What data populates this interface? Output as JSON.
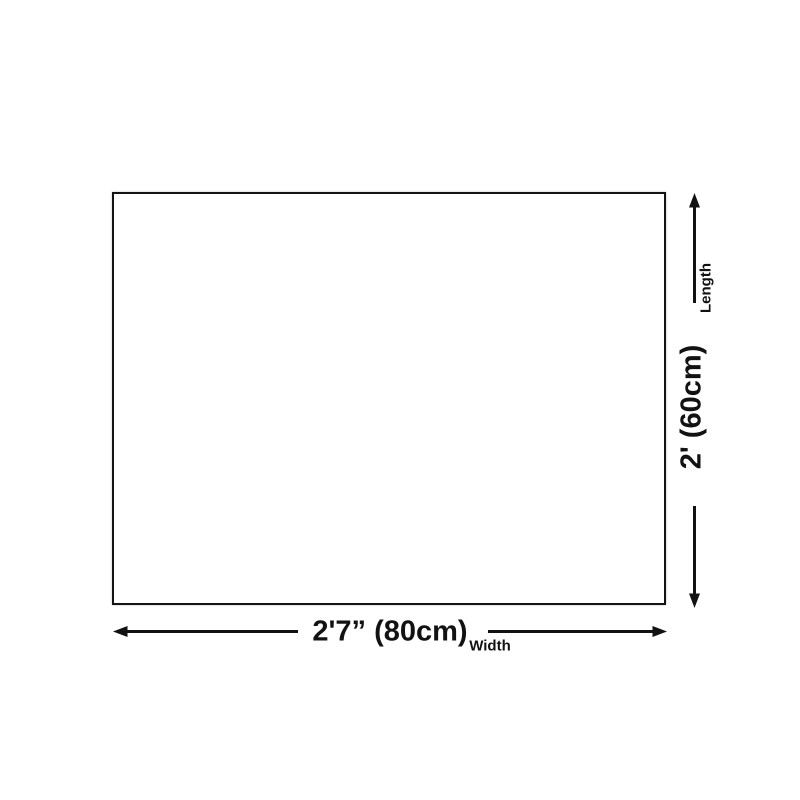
{
  "diagram": {
    "type": "product-dimension-diagram",
    "shape": "rectangle",
    "width_dimension": {
      "value": "2'7” (80cm)",
      "label": "Width"
    },
    "length_dimension": {
      "value": "2' (60cm)",
      "label": "Length"
    },
    "colors": {
      "background": "#ffffff",
      "outline": "#131313",
      "arrow": "#121212",
      "text": "#121212"
    }
  }
}
